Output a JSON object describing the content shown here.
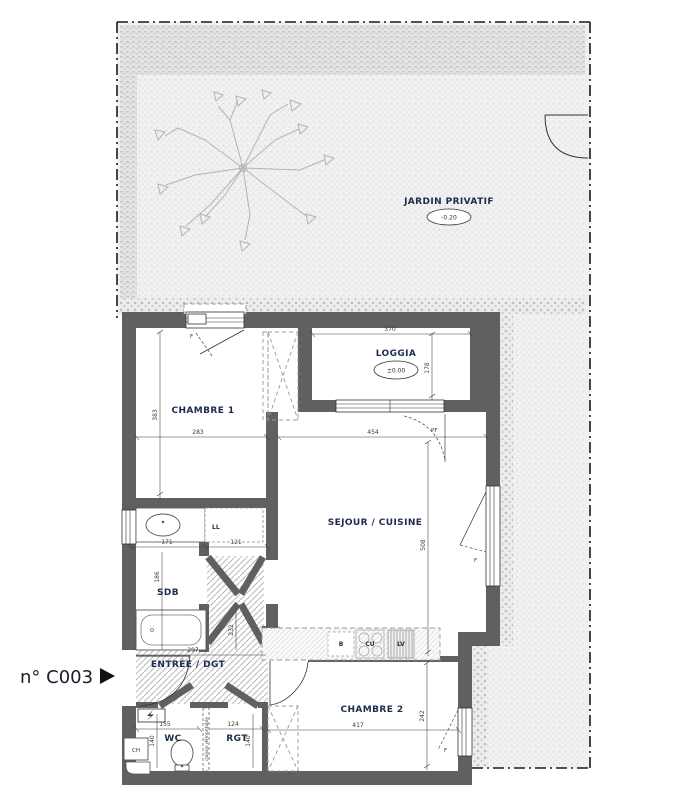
{
  "unit": {
    "label": "n° C003"
  },
  "garden": {
    "name": "JARDIN PRIVATIF",
    "level": "-0.20"
  },
  "loggia": {
    "name": "LOGGIA",
    "level": "±0.00",
    "dim_w": "370",
    "dim_d": "178"
  },
  "chambre1": {
    "name": "CHAMBRE 1",
    "dim_w": "283",
    "dim_d": "383",
    "window": "F"
  },
  "sejour": {
    "name": "SEJOUR / CUISINE",
    "dim_w": "454",
    "dim_d": "508",
    "door": "PF",
    "window": "F"
  },
  "sdb": {
    "name": "SDB",
    "dim_w": "171",
    "dim_d": "186",
    "washer": "LL"
  },
  "couloir": {
    "dim_w": "121",
    "dim_d": "232"
  },
  "entree": {
    "name": "ENTRÉE / DGT",
    "dim_w": "297"
  },
  "wc": {
    "name": "WC",
    "dim_w": "155",
    "dim_d": "140",
    "heater": "CH"
  },
  "rgt": {
    "name": "RGT",
    "dim_w": "124",
    "dim_d": "140",
    "partition": "cloison démontable"
  },
  "chambre2": {
    "name": "CHAMBRE 2",
    "dim_w": "417",
    "dim_d": "242",
    "window": "F"
  },
  "kitchen": {
    "sink": "B",
    "hob": "CU",
    "dishwasher": "LV"
  }
}
